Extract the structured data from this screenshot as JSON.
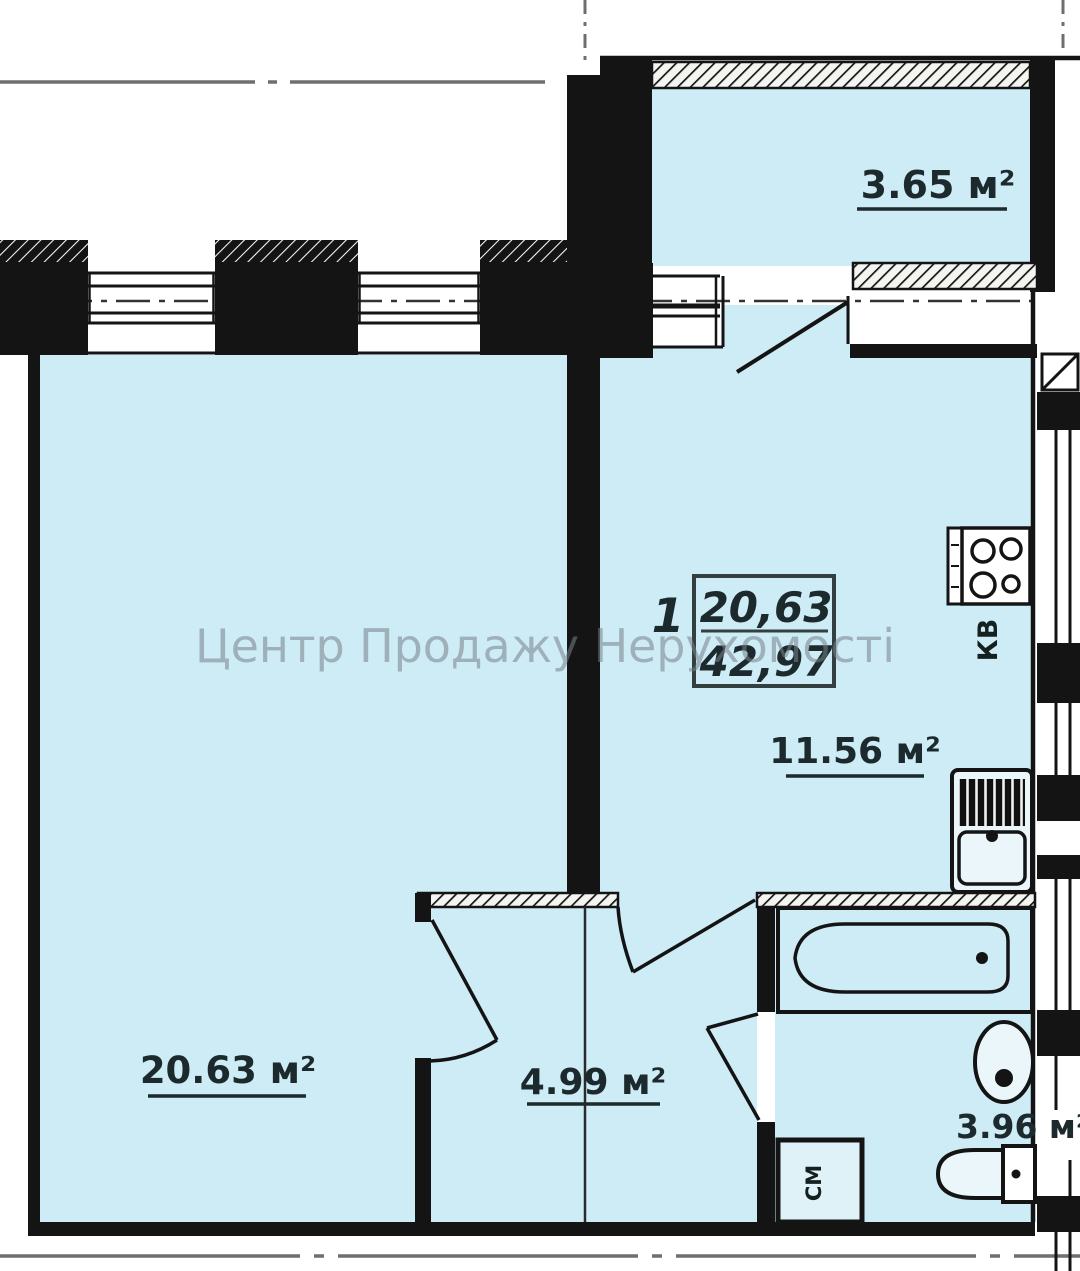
{
  "watermark": "Центр Продажу Нерухомості",
  "apartment": {
    "number": "1",
    "living_area": "20,63",
    "total_area": "42,97"
  },
  "rooms": {
    "balcony": {
      "area_label": "3.65 м²"
    },
    "living_room": {
      "area_label": "20.63 м²"
    },
    "kitchen": {
      "area_label": "11.56 м²"
    },
    "hallway": {
      "area_label": "4.99 м²"
    },
    "bathroom": {
      "area_label": "3.96 м²"
    }
  },
  "fixtures": {
    "stove_label": "КВ",
    "washing_machine_label": "СМ"
  },
  "colors": {
    "floor": "#cdecf6",
    "wall": "#141414",
    "axis": "#6f6f6f",
    "watermark": "#79828a"
  }
}
